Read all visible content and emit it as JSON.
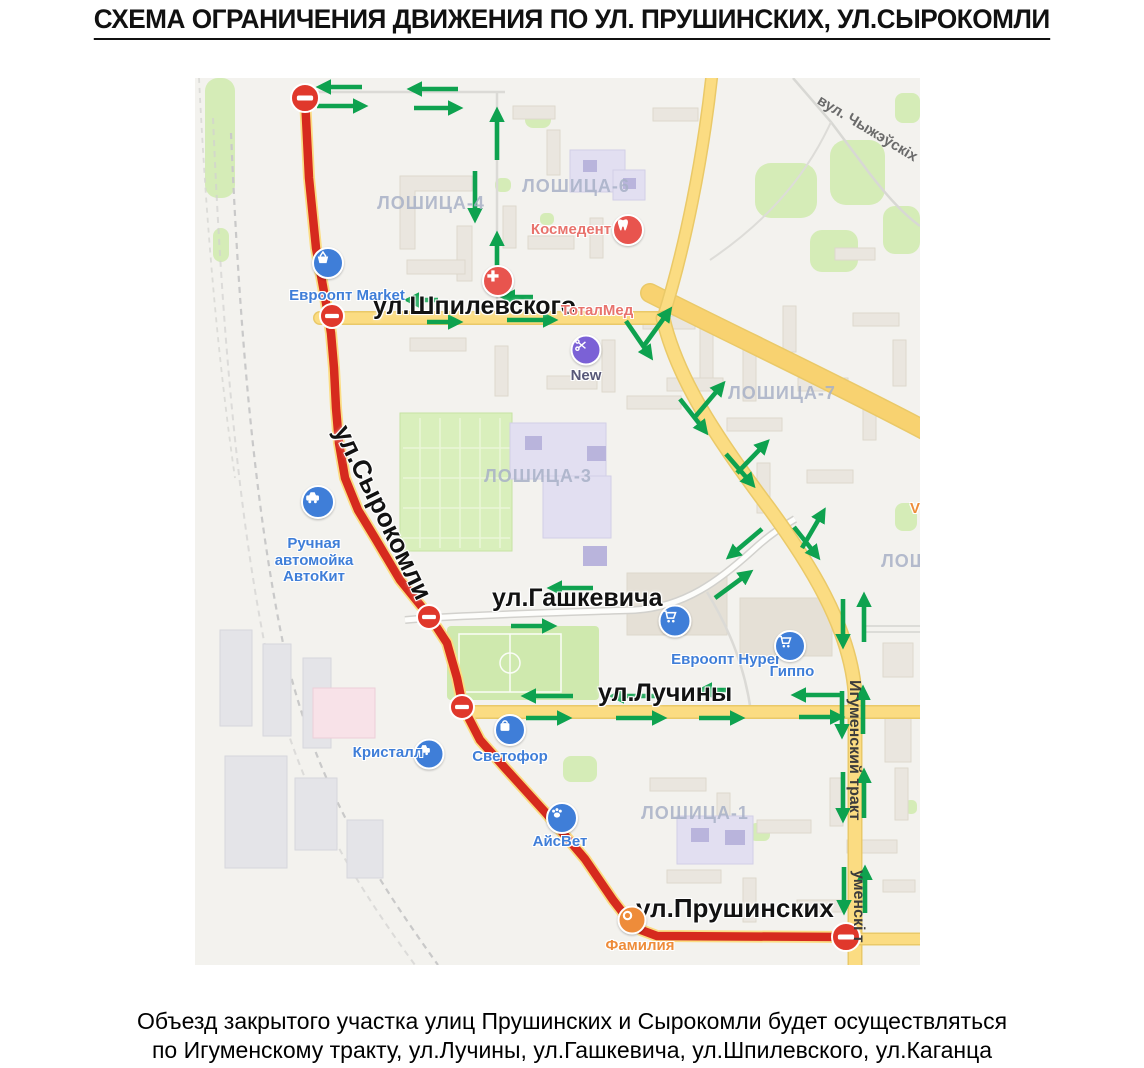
{
  "title": "СХЕМА ОГРАНИЧЕНИЯ ДВИЖЕНИЯ ПО УЛ. ПРУШИНСКИХ, УЛ.СЫРОКОМЛИ",
  "caption": {
    "line1": "Объезд закрытого участка улиц Прушинских и Сырокомли будет осуществляться",
    "line2": "по Игуменскому тракту, ул.Лучины, ул.Гашкевича, ул.Шпилевского, ул.Каганца"
  },
  "colors": {
    "closed_route": "#d62a1e",
    "road_yellow": "#fbdc82",
    "no_entry": "#e0382c",
    "detour_green": "#0ea24f",
    "poi_blue": "#3f7ed8",
    "poi_red": "#e8544e",
    "poi_purple": "#7b61d6",
    "poi_orange": "#ee8c3a",
    "district_gray": "#a8b1c7"
  },
  "map": {
    "street_labels": [
      {
        "text": "ул.Шпилевского",
        "x": 178,
        "y": 214,
        "size": 25,
        "rotate": 0
      },
      {
        "text": "ул.Сырокомли",
        "x": 160,
        "y": 342,
        "size": 26,
        "rotate": 64
      },
      {
        "text": "ул.Гашкевича",
        "x": 297,
        "y": 506,
        "size": 25,
        "rotate": 0
      },
      {
        "text": "ул.Лучины",
        "x": 403,
        "y": 601,
        "size": 25,
        "rotate": 0
      },
      {
        "text": "ул.Прушинских",
        "x": 441,
        "y": 815,
        "size": 26,
        "rotate": 0
      }
    ],
    "district_labels": [
      {
        "text": "ЛОШИЦА-4",
        "x": 236,
        "y": 115
      },
      {
        "text": "ЛОШИЦА-6",
        "x": 381,
        "y": 98
      },
      {
        "text": "ЛОШИЦА-3",
        "x": 343,
        "y": 388
      },
      {
        "text": "ЛОШИЦА-7",
        "x": 587,
        "y": 305
      },
      {
        "text": "ЛОШИЦА-1",
        "x": 500,
        "y": 725
      },
      {
        "text": "ЛОШ",
        "x": 710,
        "y": 473
      }
    ],
    "rotated_labels": [
      {
        "text": "вул. Чыжэўскіх",
        "x": 628,
        "y": 14,
        "rotate": 31,
        "size": 15,
        "color": "#6a6a6a"
      },
      {
        "text": "Игуменский тракт",
        "x": 668,
        "y": 602,
        "rotate": 90,
        "size": 16,
        "color": "#3c3c3c"
      },
      {
        "text": "уменскі т",
        "x": 672,
        "y": 792,
        "rotate": 90,
        "size": 16,
        "color": "#3c3c3c"
      }
    ],
    "pois": [
      {
        "lines": [
          "Евроопт Market"
        ],
        "icon": "basket",
        "icon_x": 133,
        "icon_y": 185,
        "icon_size": 28,
        "icon_bg": "#3f7ed8",
        "color": "#3f7ed8",
        "label_x": 152,
        "label_y": 210
      },
      {
        "lines": [
          "Космедент"
        ],
        "icon": "tooth",
        "icon_x": 433,
        "icon_y": 152,
        "icon_size": 28,
        "icon_bg": "#e8544e",
        "color": "#e8736d",
        "label_x": 376,
        "label_y": 144
      },
      {
        "lines": [
          "ТоталМед"
        ],
        "icon": "cross",
        "icon_x": 303,
        "icon_y": 203,
        "icon_size": 28,
        "icon_bg": "#e8544e",
        "color": "#e8736d",
        "label_x": 402,
        "label_y": 225
      },
      {
        "lines": [
          "New"
        ],
        "icon": "scissors",
        "icon_x": 391,
        "icon_y": 272,
        "icon_size": 27,
        "icon_bg": "#7b61d6",
        "color": "#585878",
        "label_x": 391,
        "label_y": 290
      },
      {
        "lines": [
          "Ручная",
          "автомойка",
          "АвтоКит"
        ],
        "icon": "car",
        "icon_x": 123,
        "icon_y": 424,
        "icon_size": 30,
        "icon_bg": "#3f7ed8",
        "color": "#3f7ed8",
        "label_x": 119,
        "label_y": 458
      },
      {
        "lines": [
          "Кристалл"
        ],
        "icon": "car",
        "icon_x": 234,
        "icon_y": 676,
        "icon_size": 27,
        "icon_bg": "#3f7ed8",
        "color": "#3f7ed8",
        "label_x": 193,
        "label_y": 667
      },
      {
        "lines": [
          "Светофор"
        ],
        "icon": "bag",
        "icon_x": 315,
        "icon_y": 652,
        "icon_size": 28,
        "icon_bg": "#3f7ed8",
        "color": "#3f7ed8",
        "label_x": 315,
        "label_y": 671
      },
      {
        "lines": [
          "АйсВет"
        ],
        "icon": "paw",
        "icon_x": 367,
        "icon_y": 740,
        "icon_size": 28,
        "icon_bg": "#3f7ed8",
        "color": "#3f7ed8",
        "label_x": 365,
        "label_y": 756
      },
      {
        "lines": [
          "Евроопт Hyper"
        ],
        "icon": "cart",
        "icon_x": 480,
        "icon_y": 543,
        "icon_size": 29,
        "icon_bg": "#3f7ed8",
        "color": "#3f7ed8",
        "label_x": 531,
        "label_y": 574
      },
      {
        "lines": [
          "Гиппо"
        ],
        "icon": "cart",
        "icon_x": 595,
        "icon_y": 568,
        "icon_size": 28,
        "icon_bg": "#3f7ed8",
        "color": "#3f7ed8",
        "label_x": 597,
        "label_y": 586
      },
      {
        "lines": [
          "Фамилия"
        ],
        "icon": "ring",
        "icon_x": 437,
        "icon_y": 842,
        "icon_size": 25,
        "icon_bg": "#ee8c3a",
        "color": "#ee8c3a",
        "label_x": 445,
        "label_y": 860
      },
      {
        "lines": [
          "V"
        ],
        "icon": "",
        "icon_x": 0,
        "icon_y": 0,
        "icon_size": 0,
        "icon_bg": "",
        "color": "#ee8c3a",
        "label_x": 720,
        "label_y": 423
      }
    ],
    "closed_route": {
      "points": [
        [
          110,
          20
        ],
        [
          114,
          100
        ],
        [
          121,
          170
        ],
        [
          131,
          225
        ],
        [
          136,
          255
        ],
        [
          139,
          290
        ],
        [
          141,
          330
        ],
        [
          144,
          365
        ],
        [
          150,
          400
        ],
        [
          163,
          432
        ],
        [
          180,
          460
        ],
        [
          205,
          502
        ],
        [
          235,
          539
        ],
        [
          252,
          565
        ],
        [
          262,
          600
        ],
        [
          268,
          629
        ],
        [
          285,
          662
        ],
        [
          310,
          690
        ],
        [
          350,
          734
        ],
        [
          390,
          781
        ],
        [
          418,
          822
        ],
        [
          432,
          840
        ],
        [
          446,
          852
        ],
        [
          462,
          858
        ],
        [
          650,
          859
        ]
      ]
    },
    "no_entry_markers": [
      {
        "x": 110,
        "y": 20,
        "r": 14
      },
      {
        "x": 137,
        "y": 238,
        "r": 12
      },
      {
        "x": 234,
        "y": 539,
        "r": 12
      },
      {
        "x": 267,
        "y": 629,
        "r": 12
      },
      {
        "x": 651,
        "y": 859,
        "r": 14
      }
    ],
    "detour_arrows": [
      [
        167,
        9,
        126,
        9
      ],
      [
        122,
        28,
        168,
        28
      ],
      [
        263,
        11,
        217,
        11
      ],
      [
        219,
        30,
        263,
        30
      ],
      [
        302,
        82,
        302,
        34
      ],
      [
        280,
        93,
        280,
        140
      ],
      [
        302,
        205,
        302,
        158
      ],
      [
        243,
        222,
        214,
        222
      ],
      [
        232,
        244,
        263,
        244
      ],
      [
        338,
        219,
        310,
        219
      ],
      [
        312,
        242,
        358,
        242
      ],
      [
        448,
        269,
        474,
        233
      ],
      [
        431,
        243,
        455,
        278
      ],
      [
        500,
        339,
        527,
        307
      ],
      [
        485,
        321,
        510,
        353
      ],
      [
        542,
        395,
        571,
        365
      ],
      [
        531,
        376,
        557,
        406
      ],
      [
        607,
        470,
        628,
        434
      ],
      [
        599,
        449,
        622,
        478
      ],
      [
        648,
        521,
        648,
        566
      ],
      [
        669,
        564,
        669,
        519
      ],
      [
        647,
        613,
        647,
        656
      ],
      [
        668,
        656,
        668,
        612
      ],
      [
        648,
        694,
        648,
        740
      ],
      [
        669,
        740,
        669,
        695
      ],
      [
        649,
        789,
        649,
        832
      ],
      [
        670,
        835,
        670,
        792
      ],
      [
        567,
        451,
        535,
        478
      ],
      [
        520,
        520,
        554,
        495
      ],
      [
        398,
        510,
        357,
        510
      ],
      [
        316,
        548,
        357,
        548
      ],
      [
        378,
        618,
        331,
        618
      ],
      [
        331,
        640,
        372,
        640
      ],
      [
        462,
        618,
        419,
        618
      ],
      [
        421,
        640,
        467,
        640
      ],
      [
        534,
        612,
        507,
        612
      ],
      [
        504,
        640,
        545,
        640
      ],
      [
        648,
        617,
        601,
        617
      ],
      [
        604,
        639,
        645,
        639
      ]
    ]
  }
}
